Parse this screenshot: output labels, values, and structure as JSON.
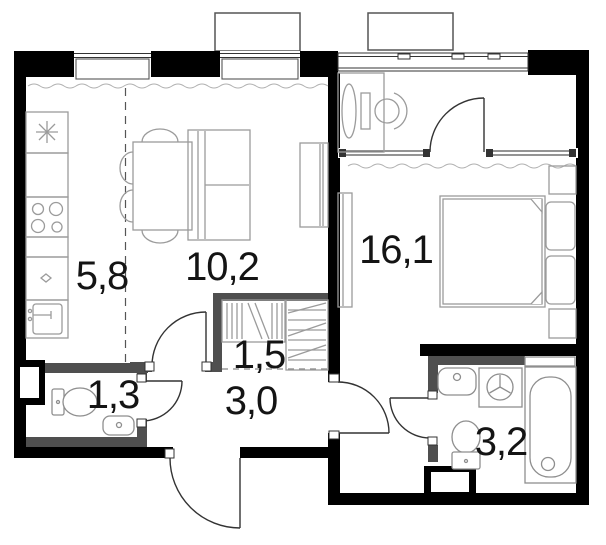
{
  "plan": {
    "rooms": [
      {
        "name": "kitchen",
        "area": "5,8"
      },
      {
        "name": "living-room",
        "area": "10,2"
      },
      {
        "name": "bedroom",
        "area": "16,1"
      },
      {
        "name": "wc",
        "area": "1,3"
      },
      {
        "name": "closet",
        "area": "1,5"
      },
      {
        "name": "hallway",
        "area": "3,0"
      },
      {
        "name": "bathroom",
        "area": "3,2"
      }
    ],
    "icons": [
      "stove-hob-icon",
      "kitchen-sink-icon",
      "dining-table-icon",
      "chair-icon",
      "sofa-icon",
      "tv-cabinet-icon",
      "bed-icon",
      "pillow-icon",
      "nightstand-icon",
      "wardrobe-icon",
      "desk-icon",
      "monitor-icon",
      "office-chair-icon",
      "toilet-icon",
      "washbasin-icon",
      "washing-machine-icon",
      "bathtub-icon",
      "door-swing-icon",
      "window-icon",
      "balcony-icon"
    ],
    "colors": {
      "wall": "#000000",
      "partition": "#4f4f4f",
      "furniture": "#9b9b9b",
      "fixture": "#8e8e8e",
      "label": "#141414",
      "background": "#ffffff"
    }
  }
}
